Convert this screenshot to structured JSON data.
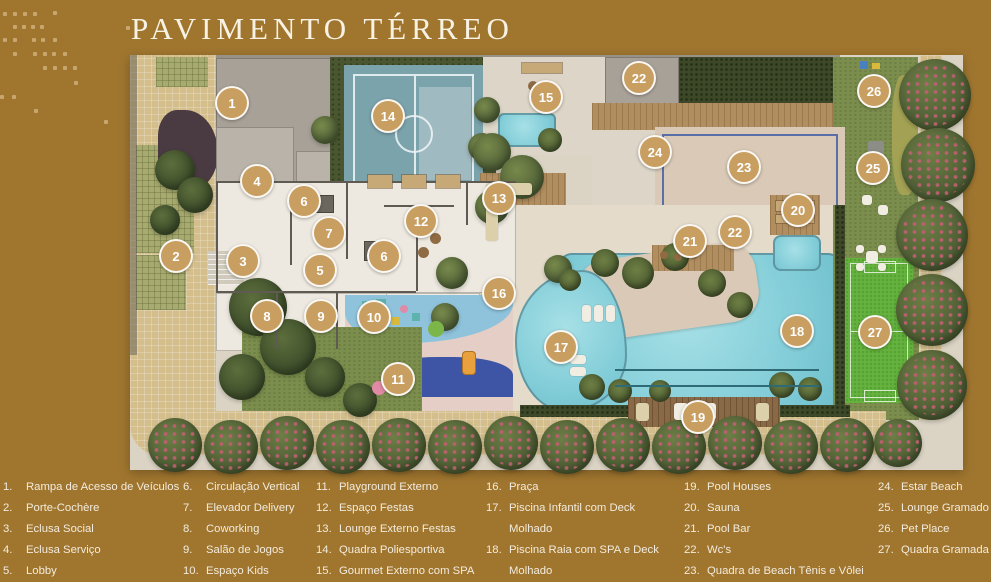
{
  "title": "PAVIMENTO TÉRREO",
  "colors": {
    "background": "#A0762F",
    "marker": "#C89E61",
    "legend_text": "#F2EBDD",
    "pool_water": "#82CDD8",
    "sports_court": "#7BA3AC",
    "beach_sand": "#D9C9B6",
    "grass_court": "#65B23E",
    "lawn": "#7C8E4D"
  },
  "plan": {
    "markers": [
      {
        "n": "1",
        "x": 102,
        "y": 48
      },
      {
        "n": "14",
        "x": 258,
        "y": 61
      },
      {
        "n": "15",
        "x": 416,
        "y": 42
      },
      {
        "n": "22",
        "x": 509,
        "y": 23
      },
      {
        "n": "26",
        "x": 744,
        "y": 36
      },
      {
        "n": "24",
        "x": 525,
        "y": 97
      },
      {
        "n": "23",
        "x": 614,
        "y": 112
      },
      {
        "n": "25",
        "x": 743,
        "y": 113
      },
      {
        "n": "4",
        "x": 127,
        "y": 126
      },
      {
        "n": "6",
        "x": 174,
        "y": 146
      },
      {
        "n": "13",
        "x": 369,
        "y": 143
      },
      {
        "n": "20",
        "x": 668,
        "y": 155
      },
      {
        "n": "12",
        "x": 291,
        "y": 166
      },
      {
        "n": "7",
        "x": 199,
        "y": 178
      },
      {
        "n": "22",
        "x": 605,
        "y": 177
      },
      {
        "n": "21",
        "x": 560,
        "y": 186
      },
      {
        "n": "2",
        "x": 46,
        "y": 201
      },
      {
        "n": "6",
        "x": 254,
        "y": 201
      },
      {
        "n": "3",
        "x": 113,
        "y": 206
      },
      {
        "n": "5",
        "x": 190,
        "y": 215
      },
      {
        "n": "16",
        "x": 369,
        "y": 238
      },
      {
        "n": "8",
        "x": 137,
        "y": 261
      },
      {
        "n": "9",
        "x": 191,
        "y": 261
      },
      {
        "n": "10",
        "x": 244,
        "y": 262
      },
      {
        "n": "18",
        "x": 667,
        "y": 276
      },
      {
        "n": "27",
        "x": 745,
        "y": 277
      },
      {
        "n": "17",
        "x": 431,
        "y": 292
      },
      {
        "n": "11",
        "x": 268,
        "y": 324
      },
      {
        "n": "19",
        "x": 568,
        "y": 362
      }
    ]
  },
  "legend": {
    "columns": [
      {
        "left": 3,
        "items": [
          {
            "n": "1.",
            "label": "Rampa de Acesso de Veículos"
          },
          {
            "n": "2.",
            "label": "Porte-Cochère"
          },
          {
            "n": "3.",
            "label": "Eclusa Social"
          },
          {
            "n": "4.",
            "label": "Eclusa Serviço"
          },
          {
            "n": "5.",
            "label": "Lobby"
          }
        ]
      },
      {
        "left": 183,
        "items": [
          {
            "n": "6.",
            "label": "Circulação Vertical"
          },
          {
            "n": "7.",
            "label": "Elevador Delivery"
          },
          {
            "n": "8.",
            "label": "Coworking"
          },
          {
            "n": "9.",
            "label": "Salão de Jogos"
          },
          {
            "n": "10.",
            "label": "Espaço Kids"
          }
        ]
      },
      {
        "left": 316,
        "items": [
          {
            "n": "11.",
            "label": "Playground Externo"
          },
          {
            "n": "12.",
            "label": "Espaço Festas"
          },
          {
            "n": "13.",
            "label": "Lounge Externo Festas"
          },
          {
            "n": "14.",
            "label": "Quadra Poliesportiva"
          },
          {
            "n": "15.",
            "label": "Gourmet Externo com SPA"
          }
        ]
      },
      {
        "left": 486,
        "items": [
          {
            "n": "16.",
            "label": "Praça"
          },
          {
            "n": "17.",
            "label": "Piscina Infantil com Deck",
            "label2": "Molhado"
          },
          {
            "n": "18.",
            "label": "Piscina Raia com SPA e Deck",
            "label2": "Molhado"
          }
        ]
      },
      {
        "left": 684,
        "items": [
          {
            "n": "19.",
            "label": "Pool Houses"
          },
          {
            "n": "20.",
            "label": "Sauna"
          },
          {
            "n": "21.",
            "label": "Pool Bar"
          },
          {
            "n": "22.",
            "label": "Wc's"
          },
          {
            "n": "23.",
            "label": "Quadra de Beach Tênis e Vôlei"
          }
        ]
      },
      {
        "left": 878,
        "items": [
          {
            "n": "24.",
            "label": "Estar Beach"
          },
          {
            "n": "25.",
            "label": "Lounge Gramado"
          },
          {
            "n": "26.",
            "label": "Pet Place"
          },
          {
            "n": "27.",
            "label": "Quadra Gramada"
          }
        ]
      }
    ]
  }
}
